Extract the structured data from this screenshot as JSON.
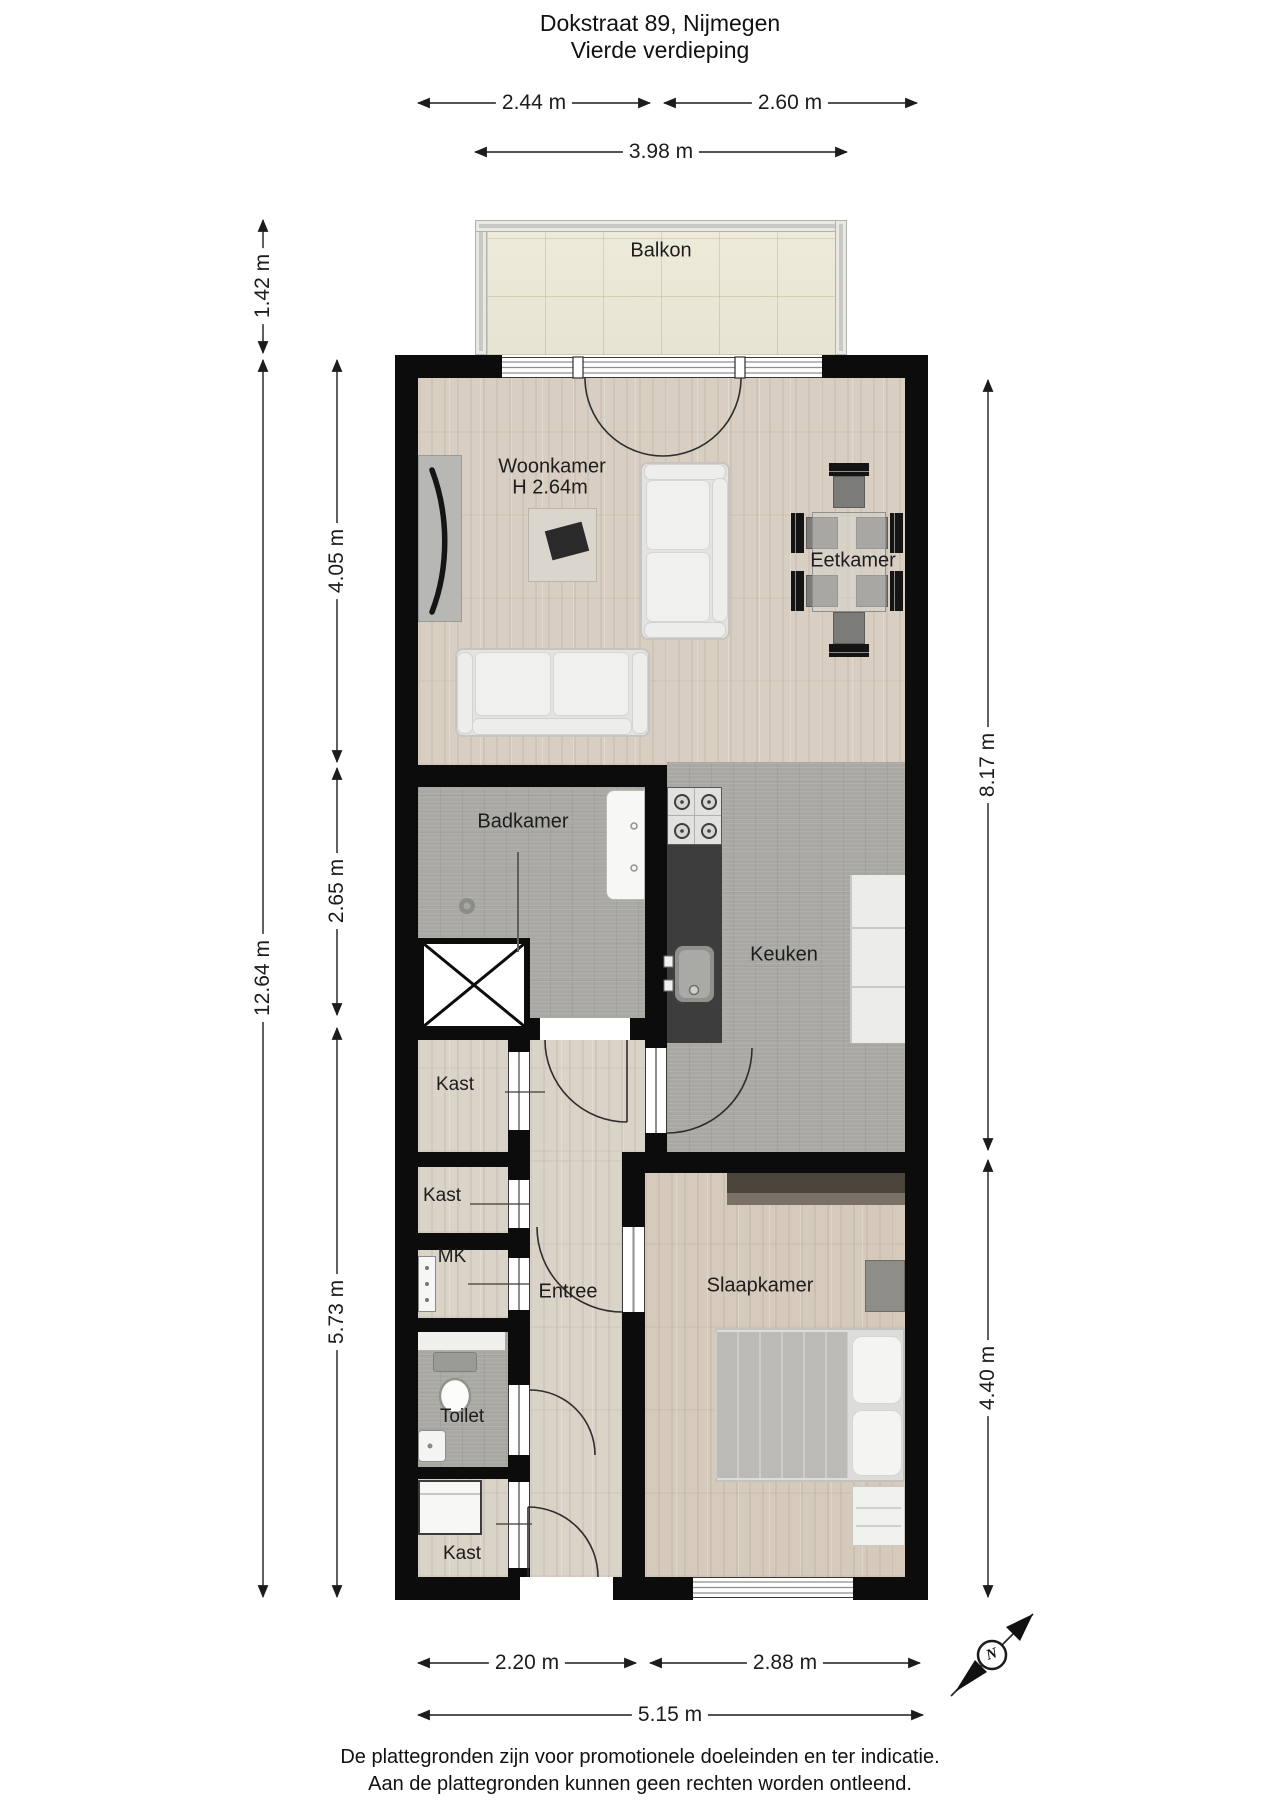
{
  "title": {
    "address": "Dokstraat 89, Nijmegen",
    "floor": "Vierde verdieping"
  },
  "rooms": {
    "balkon": "Balkon",
    "woonkamer": "Woonkamer",
    "woonkamer_ceiling_height": "H 2.64m",
    "eetkamer": "Eetkamer",
    "badkamer": "Badkamer",
    "keuken": "Keuken",
    "kast_top": "Kast",
    "kast_middle": "Kast",
    "mk": "MK",
    "entree": "Entree",
    "slaapkamer": "Slaapkamer",
    "toilet": "Toilet",
    "kast_bottom": "Kast"
  },
  "dimensions": {
    "top_left": "2.44 m",
    "top_right": "2.60 m",
    "top_total": "3.98 m",
    "left_balcony_depth": "1.42 m",
    "left_total": "12.64 m",
    "left_upper": "4.05 m",
    "left_middle": "2.65 m",
    "left_lower": "5.73 m",
    "right_upper": "8.17 m",
    "right_lower": "4.40 m",
    "bottom_left": "2.20 m",
    "bottom_right": "2.88 m",
    "bottom_total": "5.15 m"
  },
  "compass": {
    "north": "N"
  },
  "footer": {
    "line1": "De plattegronden zijn voor promotionele doeleinden en ter indicatie.",
    "line2": "Aan de plattegronden kunnen geen rechten worden ontleend."
  },
  "colors": {
    "wall": "#0c0c0c",
    "wood_floor": "#d8cfc2",
    "tile_floor": "#a9a8a2",
    "balcony_floor": "#ebe8d6",
    "kitchen_counter_dark": "#3d3d3d"
  }
}
